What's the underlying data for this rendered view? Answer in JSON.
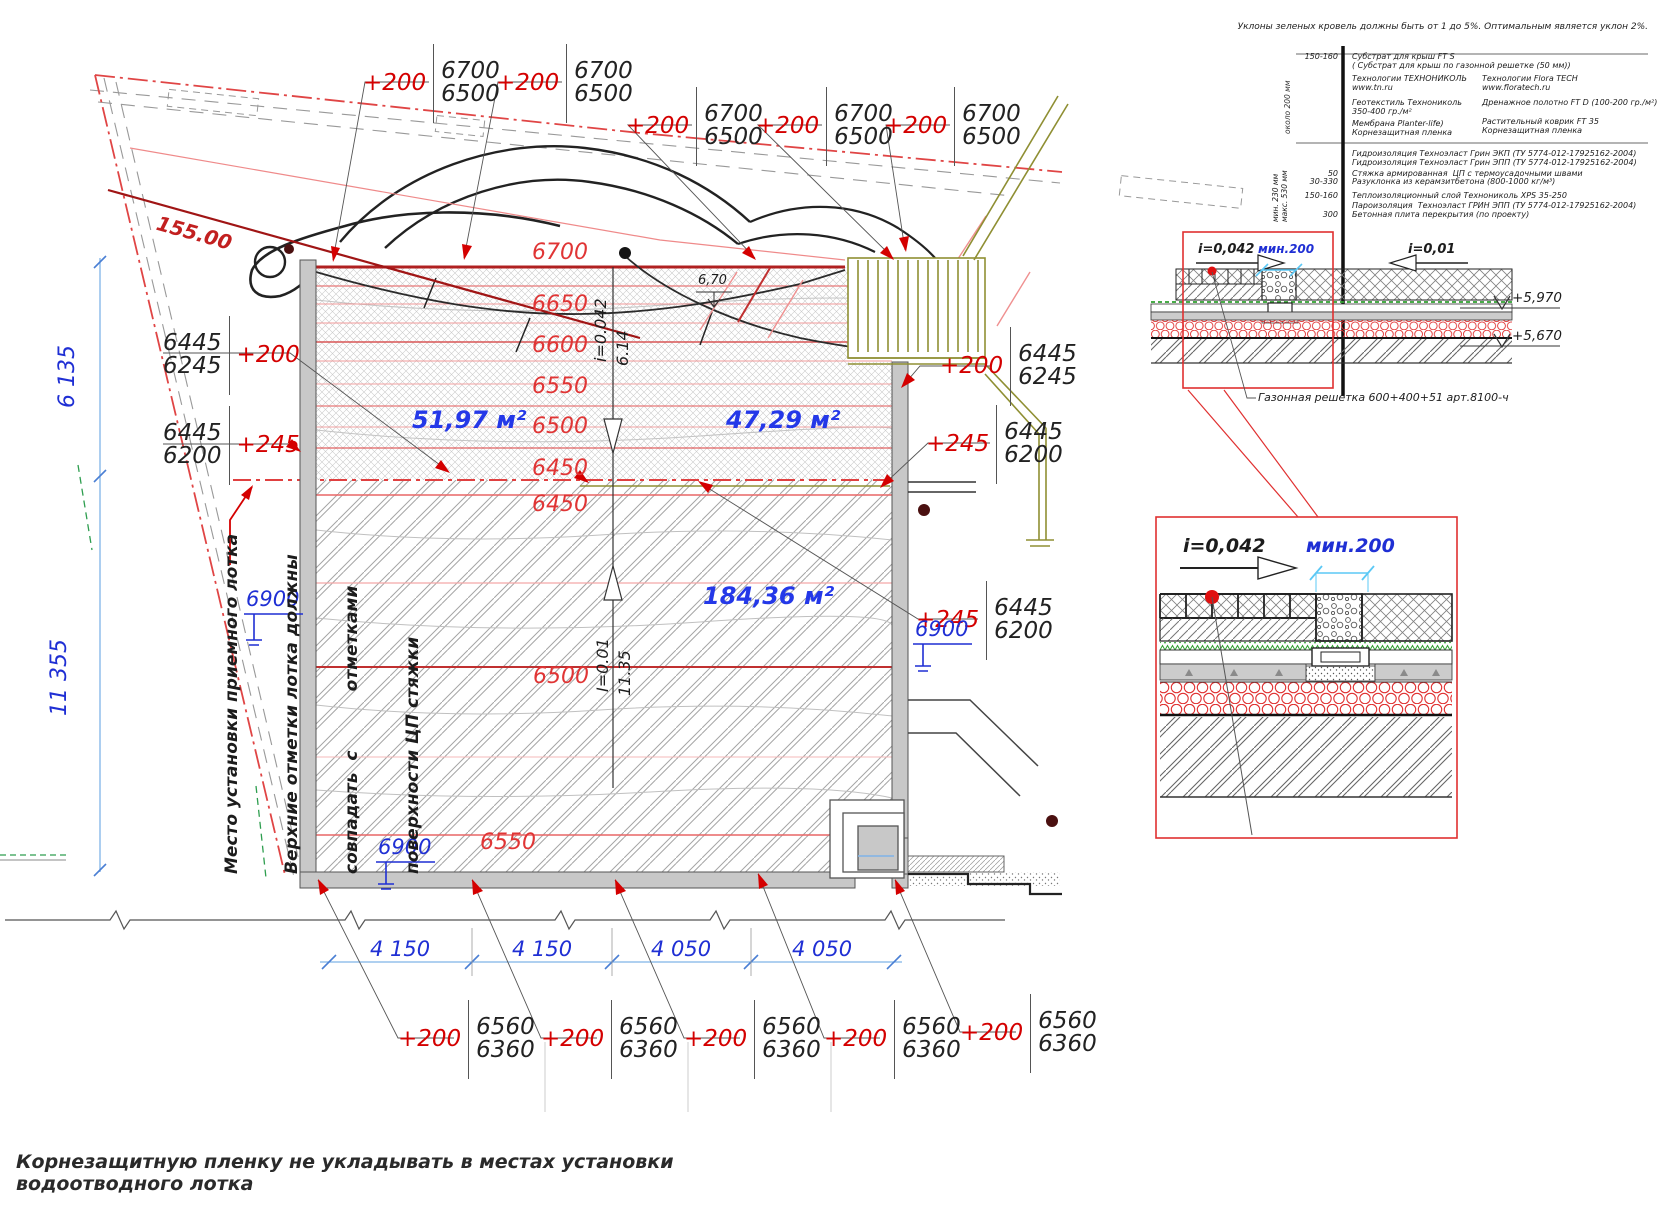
{
  "notes": {
    "top": "Уклоны зеленых кровель должны быть от 1 до 5%. Оптимальным является уклон 2%.",
    "bottom1": "Корнезащитную пленку не укладывать в местах установки",
    "bottom2": "водоотводного лотка",
    "left1": "Место установки приемного лотка",
    "left2": "Верхние отметки лотка должны",
    "left3": "совпадать  с          отметками",
    "left4": "поверхности ЦП стяжки"
  },
  "legend": {
    "top": {
      "thickness": "150-160",
      "depth": "около 200 мм",
      "sub1": "Субстрат для крыш FT S",
      "sub2": "( Субстрат для крыш по газонной решетке (50 мм))",
      "tn1": "Технологии ТЕХНОНИКОЛЬ",
      "tn2": "www.tn.ru",
      "ft1": "Технологии Flora TECH",
      "ft2": "www.floratech.ru",
      "geo1": "Геотекстиль Технониколь",
      "geo2": "350-400 гр./м²",
      "drain": "Дренажное полотно FT D (100-200 гр./м²)",
      "mem": "Мембрана Planter-life)",
      "mat": "Растительный коврик FT 35",
      "root1": "Корнезащитная пленка",
      "root2": "Корнезащитная пленка"
    },
    "base": {
      "depth1": "мин. 230 мм",
      "depth2": "макс. 530 мм",
      "rows": [
        {
          "t": "",
          "d": "Гидроизоляция Техноэласт Грин ЭКП (ТУ 5774-012-17925162-2004)"
        },
        {
          "t": "",
          "d": "Гидроизоляция Техноэласт Грин ЭПП (ТУ 5774-012-17925162-2004)"
        },
        {
          "t": "50",
          "d": "Стяжка армированная  ЦП с термоусадочными швами"
        },
        {
          "t": "30-330",
          "d": "Разуклонка из керамзитбетона (800-1000 кг/м³)"
        },
        {
          "t": "150-160",
          "d": "Теплоизоляционный слой Технониколь XPS 35-250"
        },
        {
          "t": "",
          "d": "Пароизоляция  Техноэласт ГРИН ЭПП (ТУ 5774-012-17925162-2004)"
        },
        {
          "t": "300",
          "d": "Бетонная плита перекрытия (по проекту)"
        }
      ]
    }
  },
  "detail_small": {
    "slope_left": "i=0,042",
    "min": "мин.200",
    "slope_right": "i=0,01",
    "elev1": "+5,970",
    "elev2": "+5,670",
    "grate": "Газонная решетка 600+400+51 арт.8100-ч"
  },
  "detail_large": {
    "slope": "i=0,042",
    "min": "мин.200"
  },
  "plan": {
    "boundary_elev": "155.00",
    "spot": "6,70",
    "area1": "51,97 м²",
    "area2": "47,29 м²",
    "area3": "184,36 м²",
    "slope_up_i": "i=0.042",
    "slope_up_l": "6.14",
    "slope_dn_i": "I=0.01",
    "slope_dn_l": "11.35",
    "cu": [
      "6700",
      "6650",
      "6600",
      "6550",
      "6500",
      "6450"
    ],
    "cl": [
      "6450",
      "6500",
      "6550"
    ],
    "drain": "6900",
    "mt": [
      {
        "d": "+200",
        "h": "6700",
        "l": "6500"
      },
      {
        "d": "+200",
        "h": "6700",
        "l": "6500"
      },
      {
        "d": "+200",
        "h": "6700",
        "l": "6500"
      },
      {
        "d": "+200",
        "h": "6700",
        "l": "6500"
      },
      {
        "d": "+200",
        "h": "6700",
        "l": "6500"
      }
    ],
    "ml": [
      {
        "d": "+200",
        "h": "6445",
        "l": "6245"
      },
      {
        "d": "+245",
        "h": "6445",
        "l": "6200"
      }
    ],
    "mr": [
      {
        "d": "+200",
        "h": "6445",
        "l": "6245"
      },
      {
        "d": "+245",
        "h": "6445",
        "l": "6200"
      },
      {
        "d": "+245",
        "h": "6445",
        "l": "6200"
      }
    ],
    "mb": [
      {
        "d": "+200",
        "h": "6560",
        "l": "6360"
      },
      {
        "d": "+200",
        "h": "6560",
        "l": "6360"
      },
      {
        "d": "+200",
        "h": "6560",
        "l": "6360"
      },
      {
        "d": "+200",
        "h": "6560",
        "l": "6360"
      },
      {
        "d": "+200",
        "h": "6560",
        "l": "6360"
      }
    ],
    "dv": [
      "6 135",
      "11 355"
    ],
    "dh": [
      "4 150",
      "4 150",
      "4 050",
      "4 050"
    ]
  }
}
